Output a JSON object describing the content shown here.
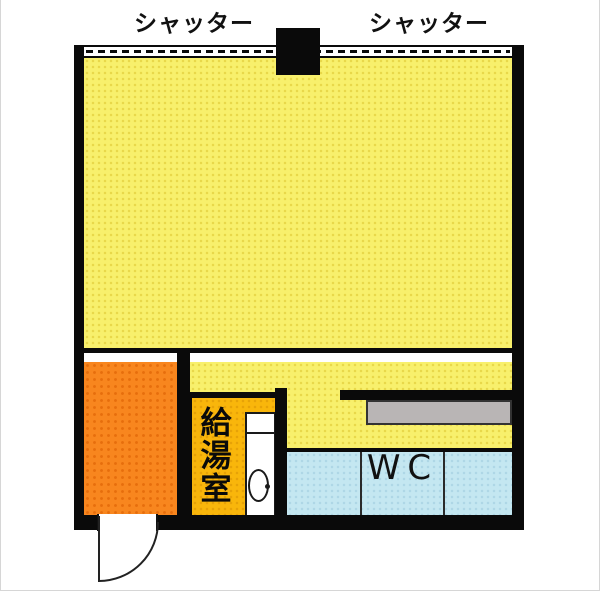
{
  "labels": {
    "shutter_left": "シャッター",
    "shutter_right": "シャッター",
    "kitchenette": "給湯室",
    "wc": "WC"
  },
  "rooms": [
    {
      "id": "main-room",
      "label": "",
      "fill": "#F8F06C",
      "note": "large open room behind shutters"
    },
    {
      "id": "service-room",
      "label": "",
      "fill": "#F8861E",
      "note": "orange room bottom-left with entry door"
    },
    {
      "id": "kitchenette",
      "label": "給湯室",
      "fill": "#F9B60B"
    },
    {
      "id": "toilet",
      "label": "WC",
      "fill": "#C4E7F1",
      "cells": 3
    }
  ],
  "fixtures": {
    "wall_color": "#0A0A0A",
    "counter_fill": "#B9B5B5",
    "pillar": "black square on top shutter wall",
    "sink": "white sink unit with bowl in kitchenette",
    "door": "quarter-arc swing door bottom-left"
  }
}
